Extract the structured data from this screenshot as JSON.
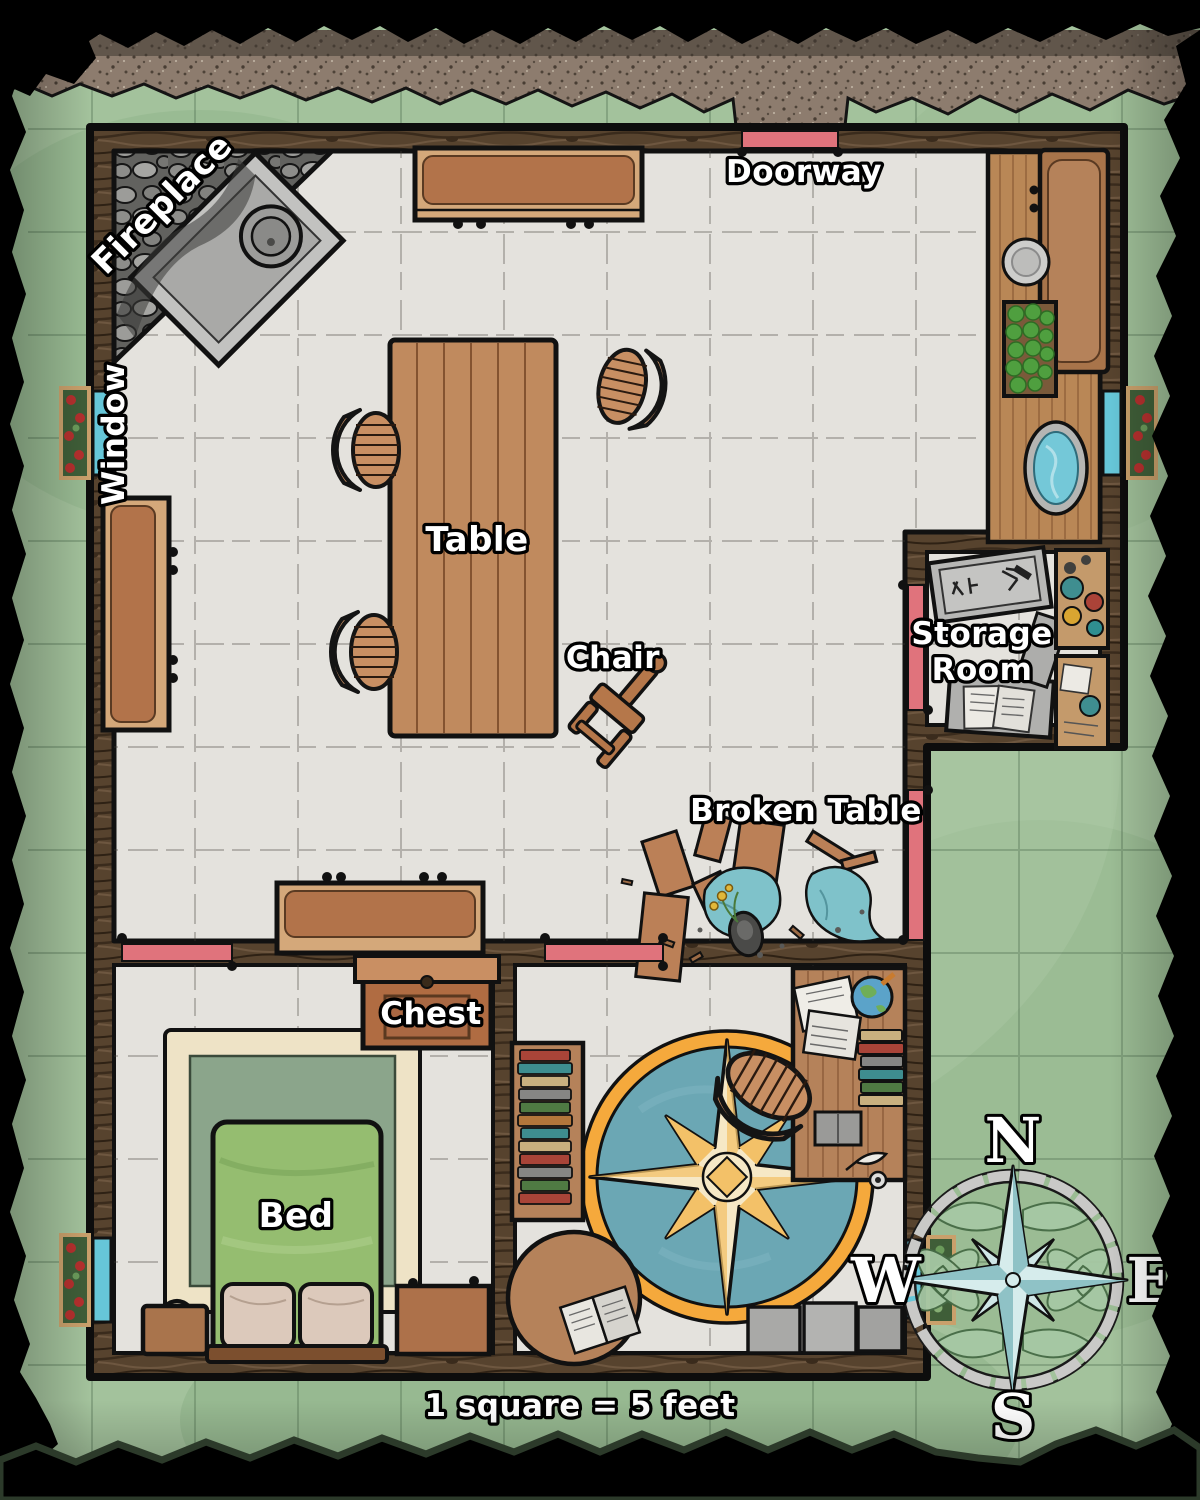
{
  "labels": {
    "fireplace": "Fireplace",
    "doorway": "Doorway",
    "window": "Window",
    "table": "Table",
    "chair": "Chair",
    "storage_line1": "Storage",
    "storage_line2": "Room",
    "broken_table": "Broken Table",
    "chest": "Chest",
    "bed": "Bed"
  },
  "compass": {
    "n": "N",
    "e": "E",
    "s": "S",
    "w": "W"
  },
  "scale_note": "1 square = 5 feet",
  "colors": {
    "grass_green": "#a3c29c",
    "floor_gray": "#e4e2dd",
    "wall_wood": "#57432e",
    "furniture_wood": "#bf8659",
    "door_red": "#e0737c",
    "window_blue": "#66c6d8",
    "rug_ring_orange": "#f5a93c",
    "rug_teal": "#6ba7b4",
    "star_cream": "#f6e8c6",
    "star_gold": "#f3c168",
    "bed_green": "#95bd70",
    "compass_star_blue": "#d6ecec",
    "cloth_teal": "#7fc2ca"
  }
}
